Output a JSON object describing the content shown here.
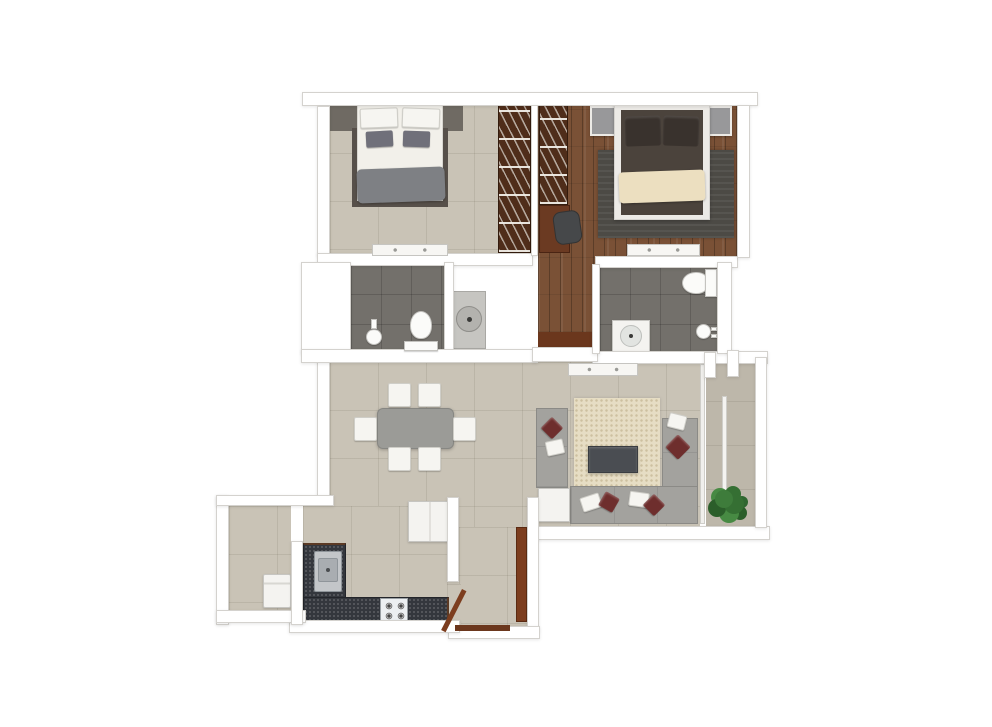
{
  "colors": {
    "canvas": "#ffffff",
    "wall_fill": "#ffffff",
    "wall_outline": "#d4d2ce",
    "floor_beige": "#c9c3b6",
    "floor_balcony": "#bdb7aa",
    "floor_wood": "#7a5136",
    "bath_tile": "#73706b",
    "counter_dark": "#34373d",
    "wardrobe_brown": "#4f2d1a",
    "door_brown": "#7c3d1e",
    "threshold_brown": "#6b371d",
    "sofa_gray": "#a3a29e",
    "rug_living": "#e6ddc4",
    "rug_master": "#4c4a45",
    "bed_white": "#f2f0ea",
    "bed_frame_dark": "#57504a",
    "gray_blanket": "#7e8084",
    "gray_pillow": "#70707a",
    "master_bed_dark": "#4b433c",
    "master_pillow": "#39322d",
    "cream_throw": "#ecdfc0",
    "pillow_maroon": "#6e2e2d",
    "furn_white": "#f4f3f0",
    "table_gray": "#9b9b97",
    "coffee_table": "#4a4d52",
    "chair_dark": "#46484a",
    "plant_green": "#3e7c3b",
    "headboard_gray": "#6f6a63",
    "sink_gray": "#c3c6c9"
  },
  "rooms": {
    "bedroom": "Bedroom",
    "master_bedroom": "Master Bedroom",
    "bathroom": "Common Bathroom",
    "master_bathroom": "Master Bathroom",
    "passage": "Passage",
    "dining": "Dining Area",
    "living": "Living Room",
    "kitchen": "Kitchen",
    "utility": "Utility Area",
    "foyer": "Entrance Foyer",
    "balcony": "Balcony",
    "vanity": "Wash Basin Counter",
    "shaft": "Duct Shaft"
  },
  "furniture": {
    "bedroom": [
      "double-bed",
      "gray-pillows",
      "gray-blanket",
      "striped-wardrobe",
      "wall-console",
      "headboard-panel"
    ],
    "master_bedroom": [
      "double-bed",
      "cream-throw",
      "dark-rug",
      "nightstand-left",
      "nightstand-right",
      "striped-wardrobe",
      "study-desk",
      "desk-chair",
      "wall-console"
    ],
    "bathroom": [
      "toilet",
      "hand-shower",
      "washbasin-round"
    ],
    "master_bathroom": [
      "toilet",
      "washbasin-square",
      "shower-mixer"
    ],
    "dining": [
      "dining-table",
      "chair-top-1",
      "chair-top-2",
      "chair-bottom-1",
      "chair-bottom-2",
      "chair-left",
      "chair-right"
    ],
    "living": [
      "sectional-sofa",
      "corner-table",
      "coffee-table",
      "area-rug",
      "tv-console",
      "maroon-pillows",
      "white-pillows",
      "potted-plant",
      "sliding-door"
    ],
    "kitchen": [
      "l-shaped-counter",
      "kitchen-sink",
      "gas-stove",
      "refrigerator"
    ],
    "utility": [
      "washing-machine"
    ],
    "foyer": [
      "main-door-leaf",
      "door-frame",
      "threshold"
    ]
  }
}
